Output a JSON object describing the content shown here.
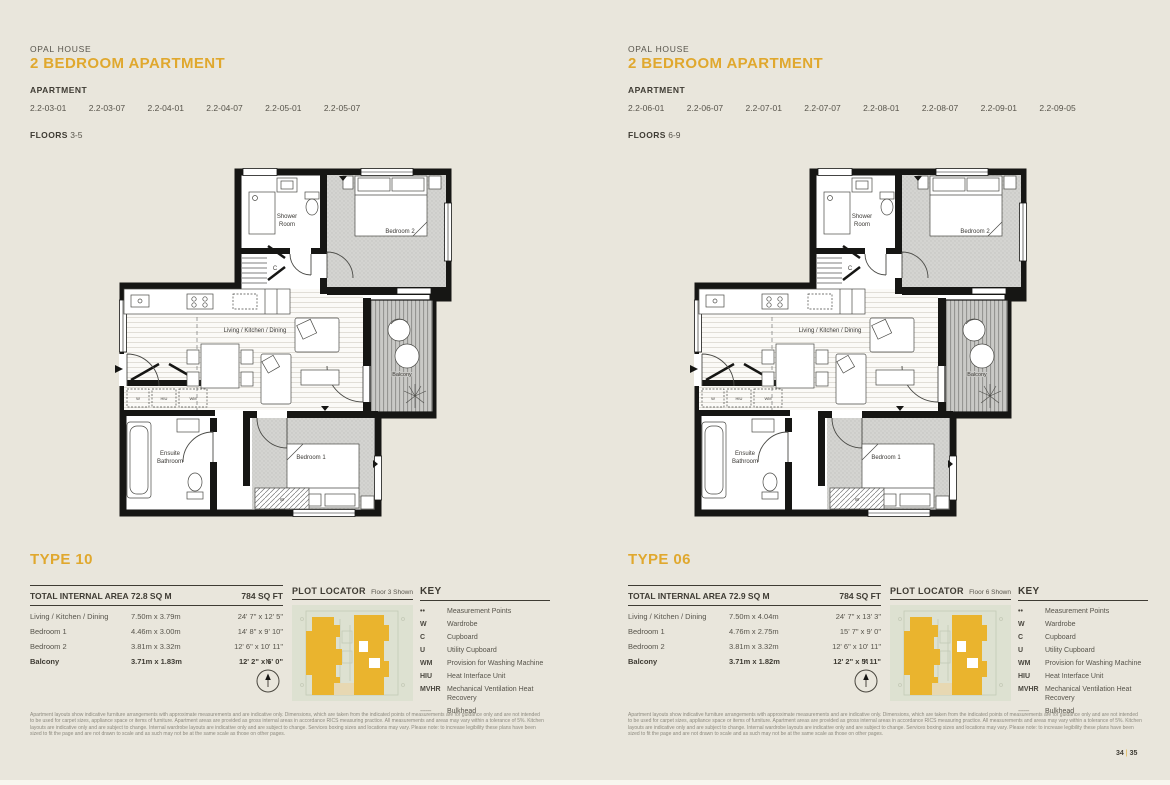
{
  "meta": {
    "accent_color": "#e0a82e",
    "page_background": "#e9e6dc",
    "wall_color": "#161614"
  },
  "pages": [
    {
      "building": "OPAL HOUSE",
      "title": "2 BEDROOM APARTMENT",
      "apartment_label": "APARTMENT",
      "apartments": [
        "2.2-03-01",
        "2.2-03-07",
        "2.2-04-01",
        "2.2-04-07",
        "2.2-05-01",
        "2.2-05-07"
      ],
      "floors_label": "FLOORS",
      "floors": "3-5",
      "type_title": "TYPE 10",
      "area_header": {
        "label": "TOTAL INTERNAL AREA",
        "sqm": "72.8 SQ M",
        "sqft": "784 SQ FT"
      },
      "rooms": [
        {
          "name": "Living / Kitchen / Dining",
          "metric": "7.50m x 3.79m",
          "imperial": "24' 7\" x 12' 5\""
        },
        {
          "name": "Bedroom 1",
          "metric": "4.46m x 3.00m",
          "imperial": "14' 8\" x 9' 10\""
        },
        {
          "name": "Bedroom 2",
          "metric": "3.81m x 3.32m",
          "imperial": "12' 6\" x 10' 11\""
        },
        {
          "name": "Balcony",
          "metric": "3.71m x 1.83m",
          "imperial": "12' 2\" x 6' 0\""
        }
      ],
      "plot_locator": {
        "title": "PLOT LOCATOR",
        "floor_shown": "Floor 3 Shown"
      }
    },
    {
      "building": "OPAL HOUSE",
      "title": "2 BEDROOM APARTMENT",
      "apartment_label": "APARTMENT",
      "apartments": [
        "2.2-06-01",
        "2.2-06-07",
        "2.2-07-01",
        "2.2-07-07",
        "2.2-08-01",
        "2.2-08-07",
        "2.2-09-01",
        "2.2-09-05"
      ],
      "floors_label": "FLOORS",
      "floors": "6-9",
      "type_title": "TYPE 06",
      "area_header": {
        "label": "TOTAL INTERNAL AREA",
        "sqm": "72.9 SQ M",
        "sqft": "784 SQ FT"
      },
      "rooms": [
        {
          "name": "Living / Kitchen / Dining",
          "metric": "7.50m x 4.04m",
          "imperial": "24' 7\" x 13' 3\""
        },
        {
          "name": "Bedroom 1",
          "metric": "4.76m x 2.75m",
          "imperial": "15' 7\" x 9' 0\""
        },
        {
          "name": "Bedroom 2",
          "metric": "3.81m x 3.32m",
          "imperial": "12' 6\" x 10' 11\""
        },
        {
          "name": "Balcony",
          "metric": "3.71m x 1.82m",
          "imperial": "12' 2\" x 5' 11\""
        }
      ],
      "plot_locator": {
        "title": "PLOT LOCATOR",
        "floor_shown": "Floor 6 Shown"
      }
    }
  ],
  "key": {
    "title": "KEY",
    "items": [
      {
        "symbol": "••",
        "label": "Measurement Points"
      },
      {
        "symbol": "W",
        "label": "Wardrobe"
      },
      {
        "symbol": "C",
        "label": "Cupboard"
      },
      {
        "symbol": "U",
        "label": "Utility Cupboard"
      },
      {
        "symbol": "WM",
        "label": "Provision for Washing Machine"
      },
      {
        "symbol": "HIU",
        "label": "Heat Interface Unit"
      },
      {
        "symbol": "MVHR",
        "label": "Mechanical Ventilation Heat Recovery"
      },
      {
        "symbol": "------",
        "label": "Bulkhead"
      }
    ]
  },
  "plan_labels": {
    "shower_line1": "Shower",
    "shower_line2": "Room",
    "bedroom2": "Bedroom 2",
    "living": "Living / Kitchen / Dining",
    "balcony": "Balcony",
    "ensuite_line1": "Ensuite",
    "ensuite_line2": "Bathroom",
    "bedroom1": "Bedroom 1",
    "cupboard": "C",
    "wardrobe": "W",
    "utility_w": "W",
    "utility_hiu": "HIU",
    "utility_wm": "WM"
  },
  "compass": {
    "north_label": "N"
  },
  "disclaimer": "Apartment layouts show indicative furniture arrangements with approximate measurements and are indicative only. Dimensions, which are taken from the indicated points of measurements are for guidance only and are not intended to be used for carpet sizes, appliance space or items of furniture. Apartment areas are provided as gross internal areas in accordance RICS measuring practice. All measurements and areas may vary within a tolerance of 5%. Kitchen layouts are indicative only and are subject to change. Internal wardrobe layouts are indicative only and are subject to change. Services boxing sizes and locations may vary. Please note: to increase legibility these plans have been sized to fit the page and are not drawn to scale and as such may not be at the same scale as those on other pages.",
  "footer": {
    "page_left": "34",
    "separator": "|",
    "page_right": "35"
  }
}
